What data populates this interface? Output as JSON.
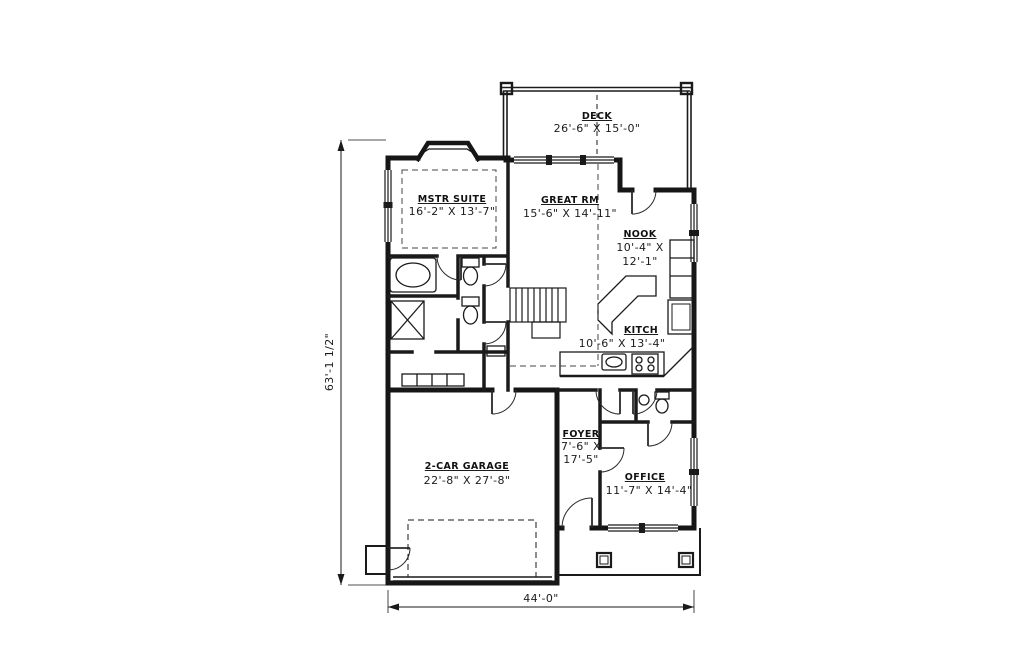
{
  "drawing_type": "first-floor-plan",
  "colors": {
    "background": "#ffffff",
    "line": "#1a1a1a"
  },
  "labels": {
    "deck": {
      "name": "DECK",
      "dims": "26'-6\" X 15'-0\""
    },
    "master_suite": {
      "name": "MSTR SUITE",
      "dims": "16'-2\" X 13'-7\""
    },
    "great_room": {
      "name": "GREAT RM",
      "dims": "15'-6\" X 14'-11\""
    },
    "nook": {
      "name": "NOOK",
      "dims_line1": "10'-4\" X",
      "dims_line2": "12'-1\""
    },
    "kitchen": {
      "name": "KITCH",
      "dims": "10'-6\" X 13'-4\""
    },
    "foyer": {
      "name": "FOYER",
      "dims_line1": "7'-6\" X",
      "dims_line2": "17'-5\""
    },
    "office": {
      "name": "OFFICE",
      "dims": "11'-7\" X 14'-4\""
    },
    "garage": {
      "name": "2-CAR GARAGE",
      "dims": "22'-8\" X 27'-8\""
    }
  },
  "overall_dimensions": {
    "height": "63'-1 1/2\"",
    "width": "44'-0\""
  }
}
